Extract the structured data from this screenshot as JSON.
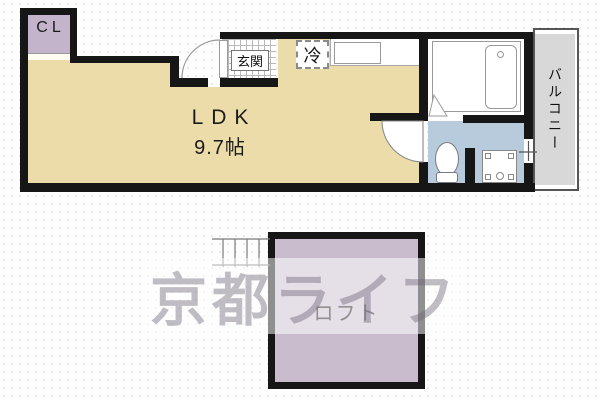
{
  "floor_plan": {
    "rooms": {
      "cl": {
        "label": "CL"
      },
      "ldk": {
        "name": "LDK",
        "size": "9.7帖"
      },
      "genkan": {
        "label": "玄関"
      },
      "fridge": {
        "label": "冷"
      },
      "balcony": {
        "label": "バルコニー"
      },
      "loft": {
        "label": "ロフト"
      }
    },
    "watermark": {
      "text": "京都ライフ"
    },
    "colors": {
      "wall": "#161616",
      "ldk_floor": "#ecdcaa",
      "closet_fill": "#c3b4cc",
      "loft_fill": "#c9bccc",
      "washroom_fill": "#b7cbdd",
      "balcony_fill": "#d8d8d8",
      "background": "#fcfdfc"
    }
  }
}
